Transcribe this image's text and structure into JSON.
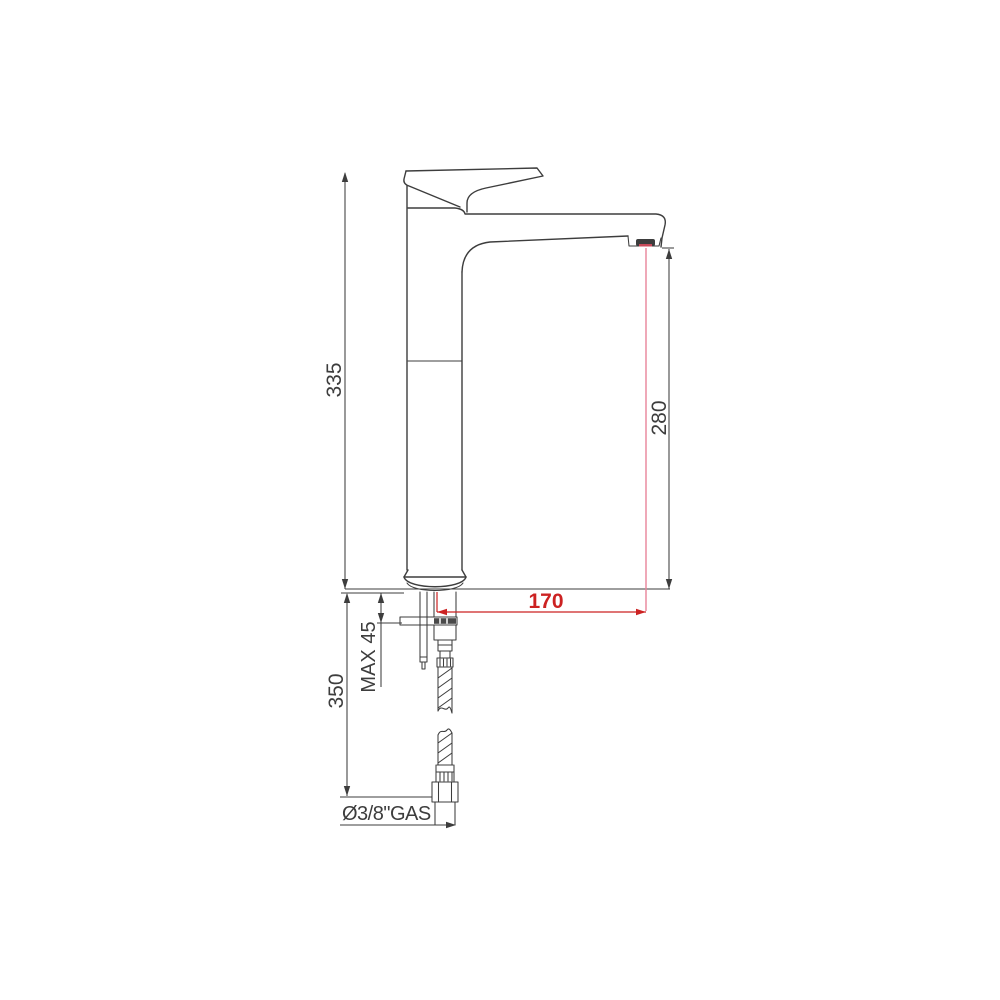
{
  "drawing": {
    "type": "technical-dimension-drawing",
    "subject": "single-lever tall basin mixer tap, side elevation with flexible supply hose",
    "background": "#ffffff",
    "line_color": "#3d3d3d",
    "accent_color": "#cc2222",
    "accent_light": "#e8849a",
    "labels": {
      "overall_height": "335",
      "spout_outlet_height": "280",
      "spout_reach": "170",
      "below_deck_length": "350",
      "max_deck_thickness": "MAX 45",
      "supply_connection": "Ø3/8\"GAS"
    }
  }
}
